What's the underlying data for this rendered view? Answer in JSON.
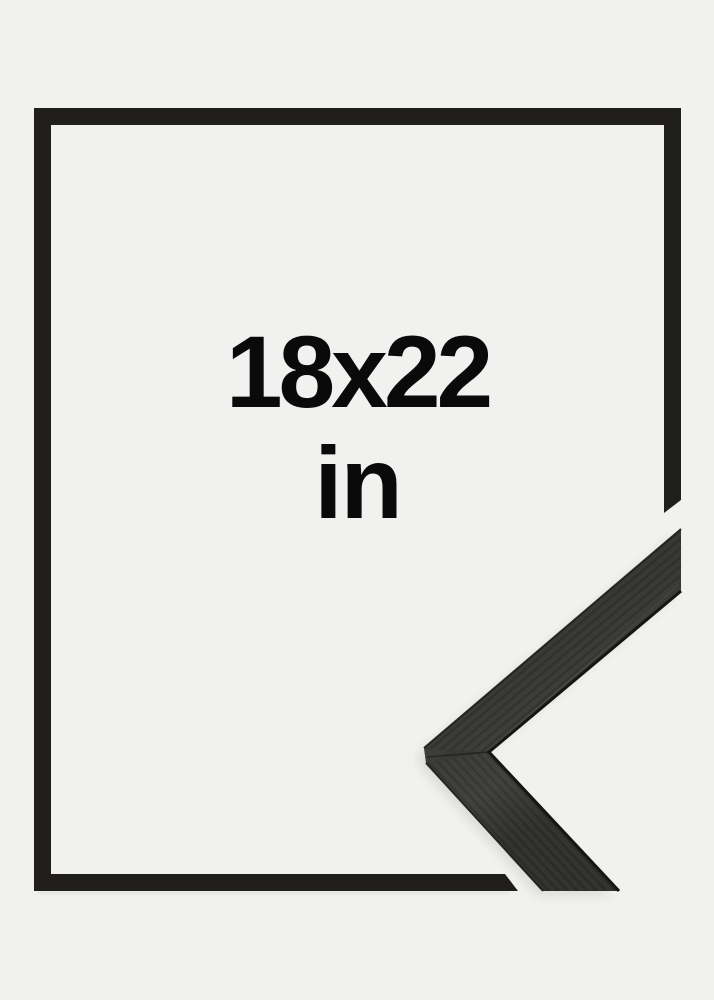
{
  "product_card": {
    "size_label": "18x22",
    "unit_label": "in"
  },
  "frame": {
    "finish_name": "black",
    "style": "thin flat moulding, mitered corner detail photo at bottom right"
  },
  "colors": {
    "background": "#f1f1ef",
    "outline": "#201f1d",
    "label_text": "#0a0a0a",
    "photo_base": "#33332f",
    "photo_light": "#3d3d3a",
    "photo_dark": "#262624",
    "photo_edge": "#151513",
    "photo_sheen": "#504e4a"
  },
  "icons": {
    "frame_outline": "frame-outline-icon",
    "frame_corner_photo": "frame-corner-photo"
  }
}
